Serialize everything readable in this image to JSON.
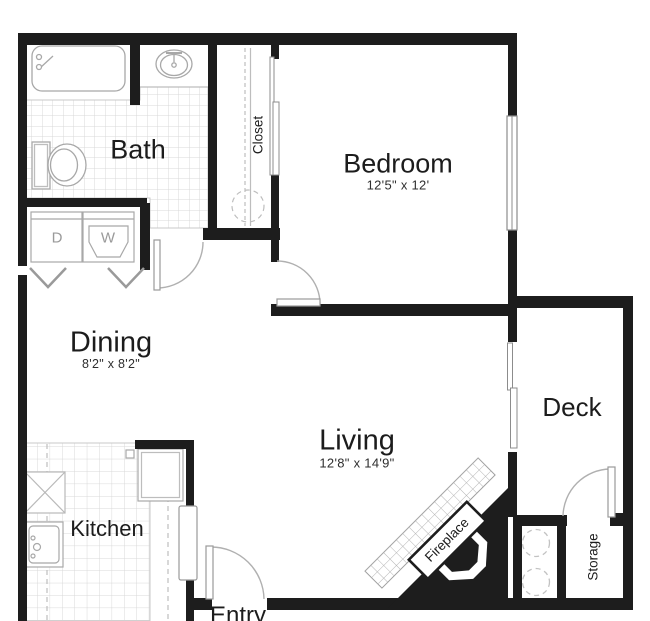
{
  "rooms": {
    "bath": {
      "label": "Bath"
    },
    "closet": {
      "label": "Closet"
    },
    "bedroom": {
      "label": "Bedroom",
      "dims": "12'5\" x 12'"
    },
    "dining": {
      "label": "Dining",
      "dims": "8'2\" x 8'2\""
    },
    "living": {
      "label": "Living",
      "dims": "12'8\" x 14'9\""
    },
    "kitchen": {
      "label": "Kitchen"
    },
    "deck": {
      "label": "Deck"
    },
    "entry": {
      "label": "Entry"
    },
    "storage": {
      "label": "Storage"
    }
  },
  "features": {
    "fireplace": {
      "label": "Fireplace"
    },
    "dryer": {
      "label": "D"
    },
    "washer": {
      "label": "W"
    }
  },
  "colors": {
    "wall": "#1d1d1d",
    "fixture_line": "#a0a0a0",
    "tile_line": "#d6d6d6",
    "dash_line": "#bdbdbd",
    "room_text": "#1c1c1c",
    "appliance_text": "#9a9a9a"
  }
}
